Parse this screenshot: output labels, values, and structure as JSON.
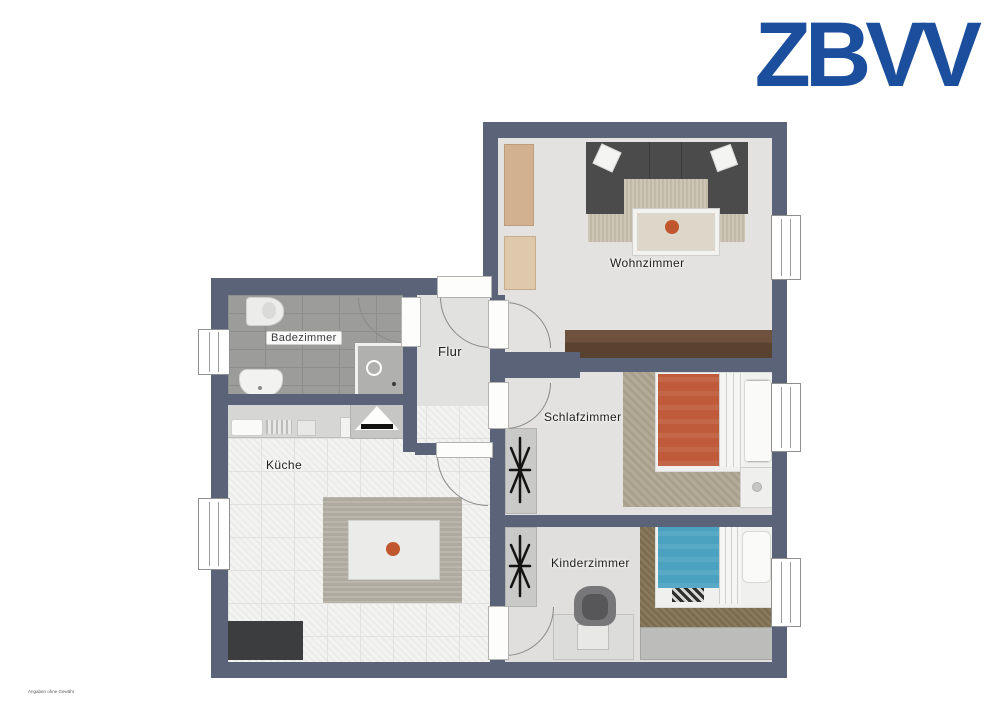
{
  "logo": {
    "text": "ZBVV"
  },
  "rooms": {
    "wohnzimmer": {
      "label": "Wohnzimmer"
    },
    "flur": {
      "label": "Flur"
    },
    "badezimmer": {
      "label": "Badezimmer"
    },
    "kueche": {
      "label": "Küche"
    },
    "schlafzimmer": {
      "label": "Schlafzimmer"
    },
    "kinderzimmer": {
      "label": "Kinderzimmer"
    }
  },
  "fine_print": "Angaben ohne Gewähr",
  "colors": {
    "logo_blue": "#1b4f9e",
    "wall": "#5a6378",
    "floor_light": "#e3e2e0",
    "bath_tile": "#9c9c9a",
    "kitchen_tile": "#f3f3f1",
    "sofa_gray": "#4b4b4b",
    "sideboard_brown": "#6e523d",
    "wood_light": "#d2b190",
    "bed_orange": "#bf5a3a",
    "bed_teal": "#4aa2c0"
  }
}
